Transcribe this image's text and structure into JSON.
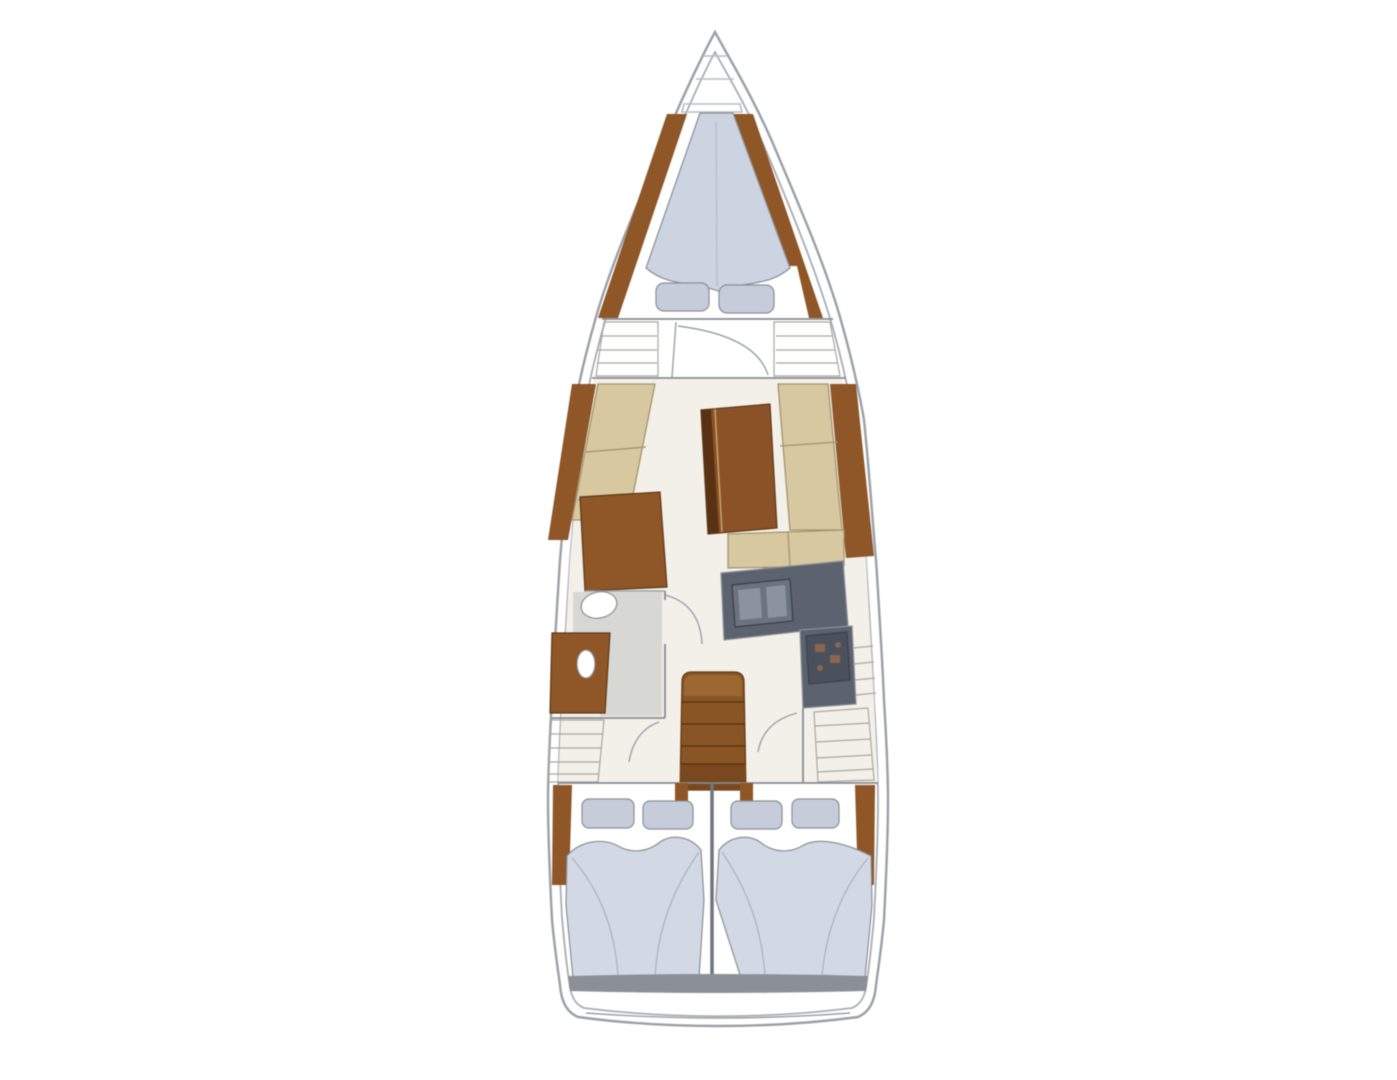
{
  "meta": {
    "title": "sailing-yacht-interior-layout-plan",
    "view": "top-down-floor-plan"
  },
  "colors": {
    "white": "#ffffff",
    "floor": "#f3f0e9",
    "wood": "#8f5627",
    "woodDark": "#6b3d18",
    "stair": "#8a5525",
    "stairTop": "#9c6733",
    "stairFoot": "#7a481e",
    "table": "#8a5226",
    "tableDark": "#583213",
    "settee": "#d7c8a0",
    "mattress": "#ccd3e1",
    "bed": "#d3d9e4",
    "pillow": "#c7ccda",
    "galley": "#5c626e",
    "galleyDark": "#4b515c",
    "sinkRim": "#6b7280",
    "sinkBasin": "#8b93a0",
    "burner": "#8a6550",
    "headFloor": "#d7d7d4",
    "lockerFill": "#eceae4",
    "transomBand": "#8b9097",
    "barLight": "#f6f7f9"
  },
  "regions": {
    "bow": "anchor-locker",
    "forward_cabin": "v-berth-with-two-pillows",
    "salon": "port-settee-starboard-l-settee-dining-table-chart-table",
    "galley": "l-counter-double-sink-stove",
    "head": "washbasin-toilet",
    "companionway": "stairs-four-steps",
    "aft_cabin_port": "double-bed-two-pillows",
    "aft_cabin_starboard": "double-bed-two-pillows",
    "stern": "transom-swim-platform"
  }
}
